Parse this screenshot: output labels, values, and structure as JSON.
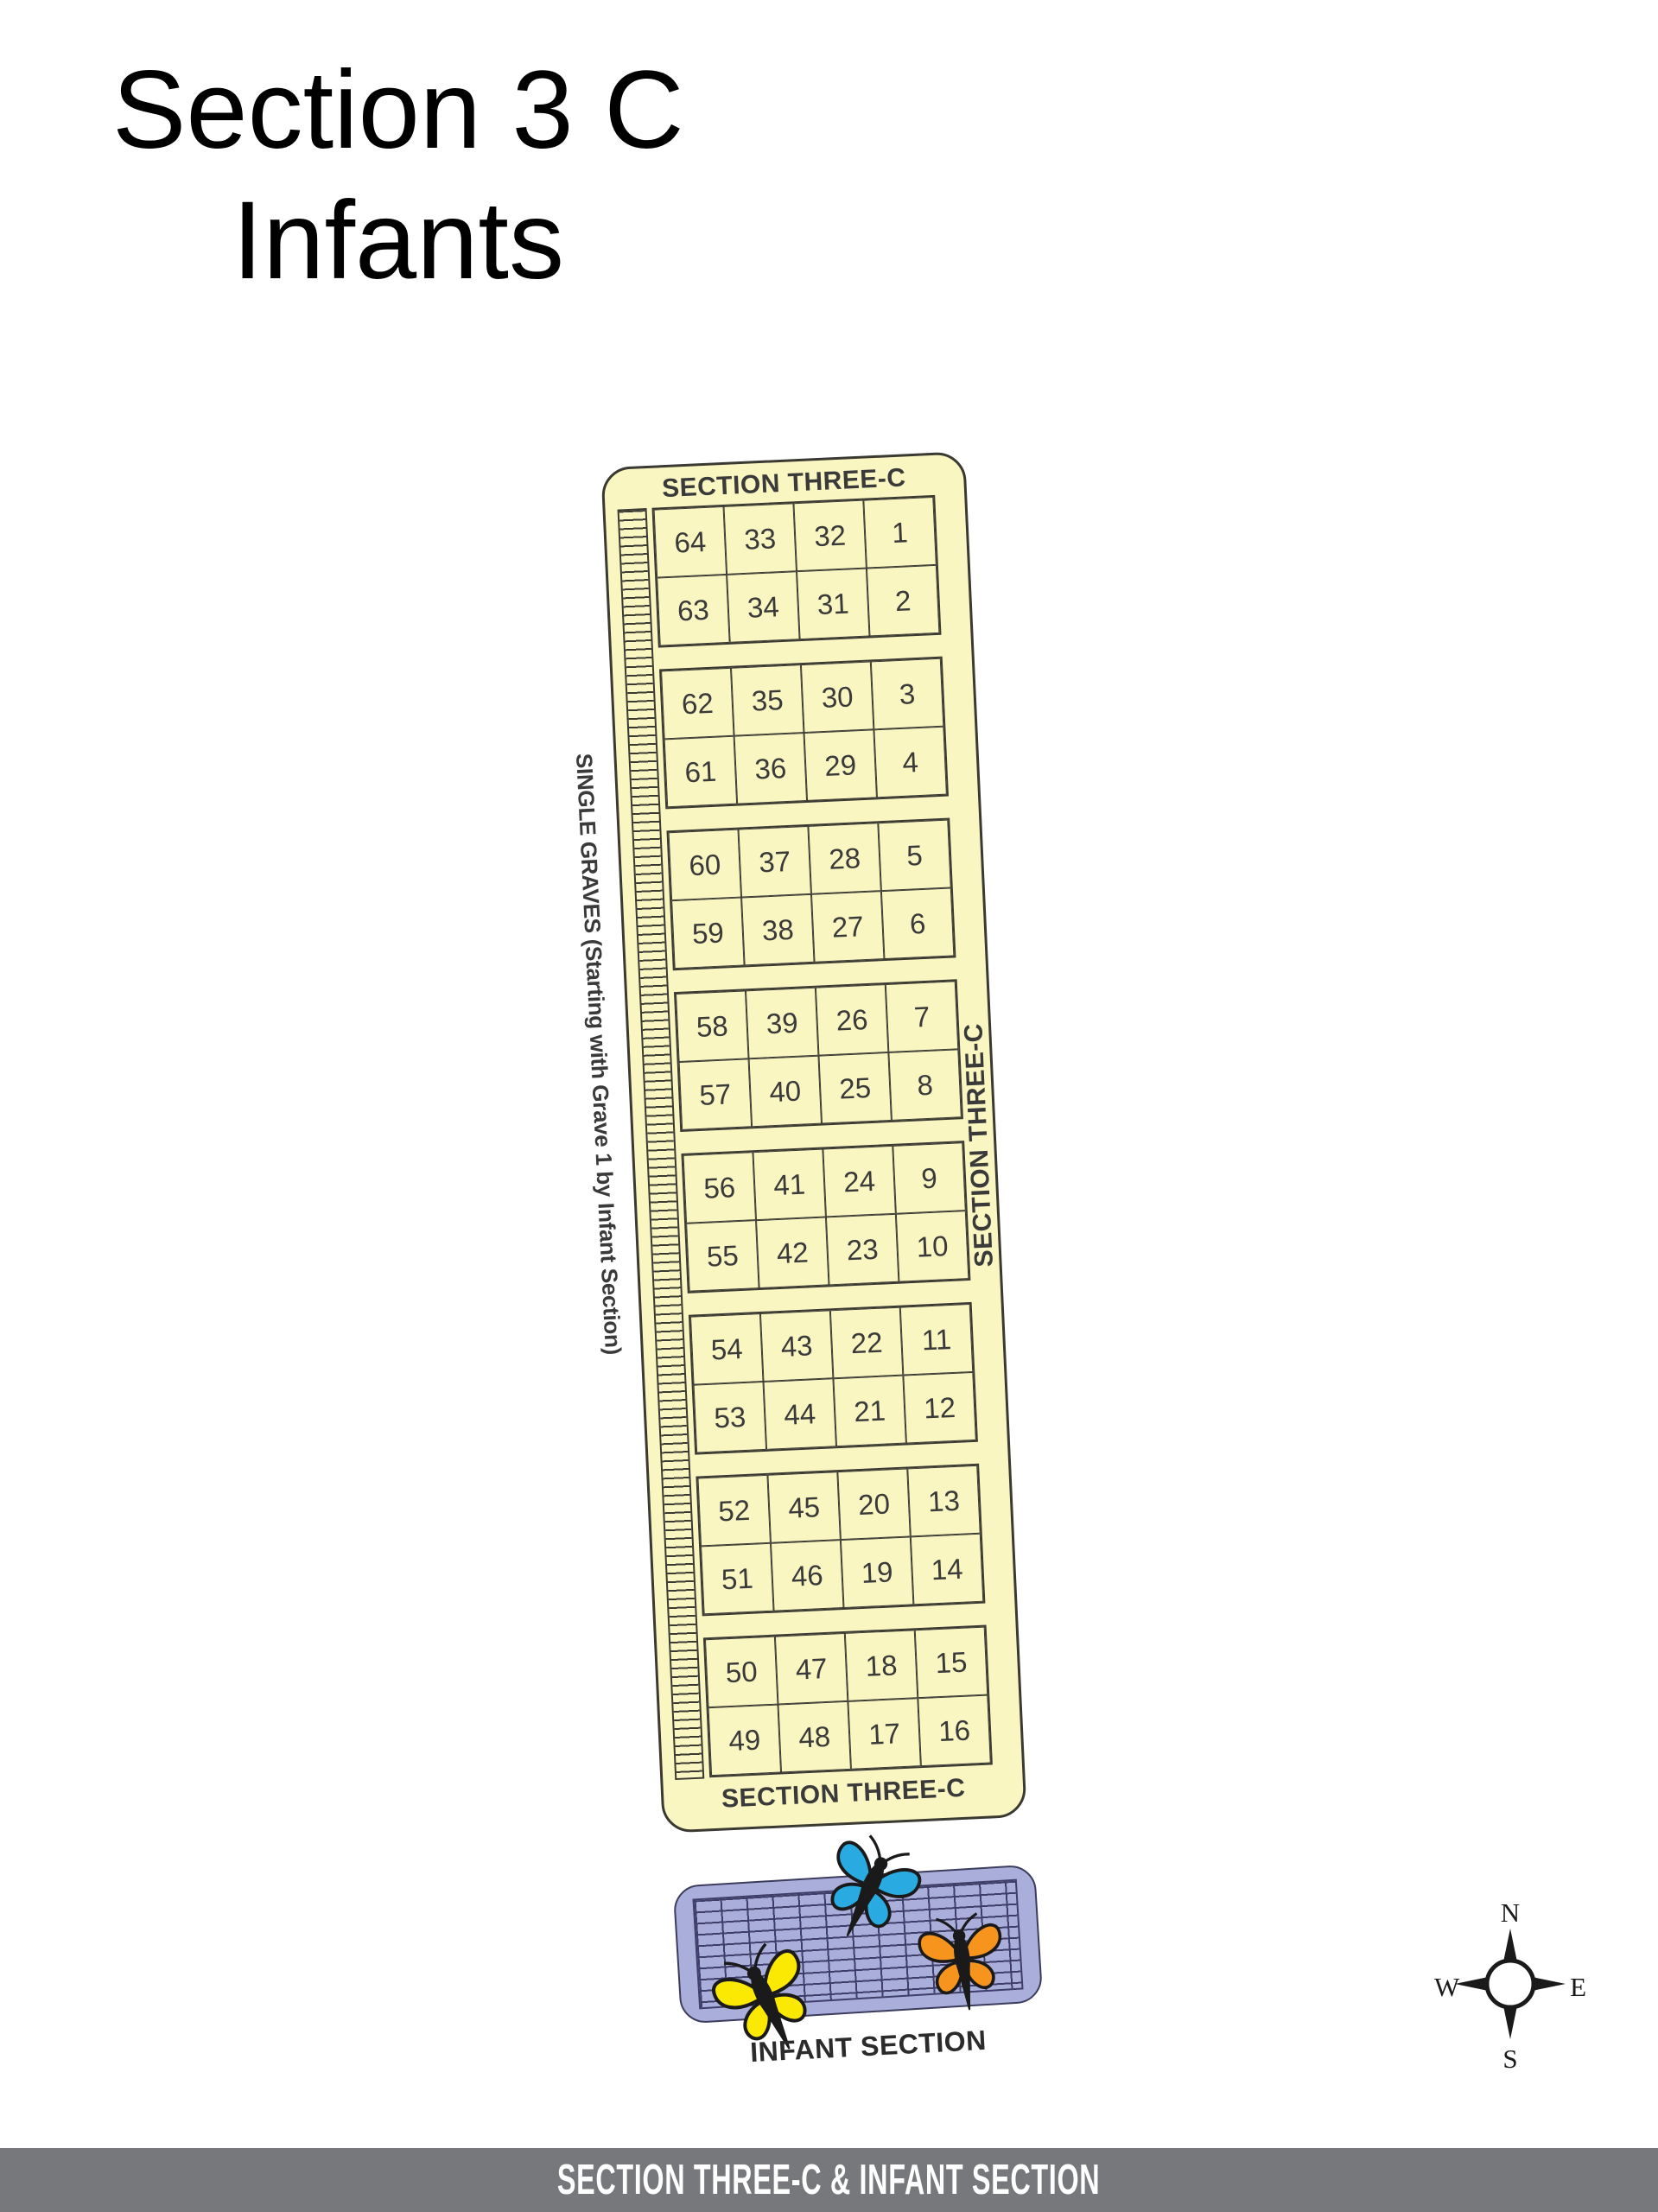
{
  "page": {
    "title_line1": "Section 3 C",
    "title_line2": "Infants"
  },
  "section_panel": {
    "top_label": "SECTION THREE-C",
    "bottom_label": "SECTION THREE-C",
    "right_label": "SECTION THREE-C",
    "left_label": "SINGLE GRAVES (Starting with Grave 1 by Infant Section)",
    "grave_rows": [
      [
        "64",
        "33",
        "32",
        "1"
      ],
      [
        "63",
        "34",
        "31",
        "2"
      ],
      [
        "62",
        "35",
        "30",
        "3"
      ],
      [
        "61",
        "36",
        "29",
        "4"
      ],
      [
        "60",
        "37",
        "28",
        "5"
      ],
      [
        "59",
        "38",
        "27",
        "6"
      ],
      [
        "58",
        "39",
        "26",
        "7"
      ],
      [
        "57",
        "40",
        "25",
        "8"
      ],
      [
        "56",
        "41",
        "24",
        "9"
      ],
      [
        "55",
        "42",
        "23",
        "10"
      ],
      [
        "54",
        "43",
        "22",
        "11"
      ],
      [
        "53",
        "44",
        "21",
        "12"
      ],
      [
        "52",
        "45",
        "20",
        "13"
      ],
      [
        "51",
        "46",
        "19",
        "14"
      ],
      [
        "50",
        "47",
        "18",
        "15"
      ],
      [
        "49",
        "48",
        "17",
        "16"
      ]
    ]
  },
  "infant_section": {
    "label": "INFANT SECTION",
    "butterflies": [
      {
        "name": "blue-butterfly"
      },
      {
        "name": "yellow-butterfly"
      },
      {
        "name": "orange-butterfly"
      }
    ]
  },
  "compass": {
    "north": "N",
    "south": "S",
    "east": "E",
    "west": "W"
  },
  "footer": {
    "text": "SECTION THREE-C & INFANT SECTION"
  },
  "theme": {
    "panel_fill": "#FAF6C2",
    "panel_line": "#3A3A33",
    "panel_text": "#3A3A3A",
    "infant_fill": "#AAAEDA",
    "infant_line": "#3E3E68",
    "footer_bg": "#77787B",
    "footer_ink": "#FFFFFF",
    "wing_blue": "#29ABE2",
    "wing_yellow": "#FCE903",
    "wing_orange": "#F7941E"
  }
}
